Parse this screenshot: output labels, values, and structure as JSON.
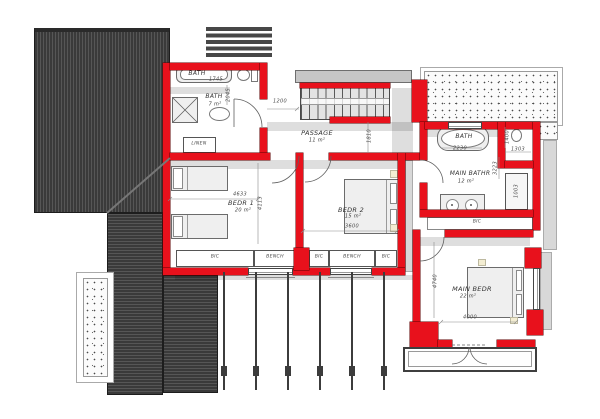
{
  "drawing": {
    "type": "first-floor plan",
    "rooms": {
      "bath": {
        "name": "BATH",
        "area": "7 m²"
      },
      "passage": {
        "name": "PASSAGE",
        "area": "11 m²"
      },
      "bedr1": {
        "name": "BEDR 1",
        "area": "20 m²"
      },
      "bedr2": {
        "name": "BEDR 2",
        "area": "15 m²"
      },
      "main_bath": {
        "name": "MAIN BATHR",
        "area": "12 m²"
      },
      "main_bed": {
        "name": "MAIN BEDR",
        "area": "22 m²"
      }
    },
    "fixtures": {
      "bath_tub_label": "BATH",
      "main_tub_label": "BATH",
      "linen_label": "LINEN",
      "main_bic_label": "BIC"
    },
    "storage": {
      "bic_a": "BIC",
      "bench_a": "BENCH",
      "bic_b": "BIC",
      "bench_b": "BENCH",
      "bic_c": "BIC"
    },
    "dims": {
      "bath_tub_w": "1745",
      "bath_d": "2045",
      "stairs_w": "1200",
      "passage_d": "1810",
      "bedr1_w": "4633",
      "bedr1_d": "4113",
      "bedr2_w": "3600",
      "main_tub_w": "2230",
      "wc_d": "1400",
      "wc_w": "1303",
      "main_bath_d": "3223",
      "closet_d": "1003",
      "main_bed_d": "4740",
      "main_bed_w": "4000"
    },
    "colors": {
      "wall_red": "#e8111c",
      "roof_dark": "#3a3a3a"
    }
  }
}
